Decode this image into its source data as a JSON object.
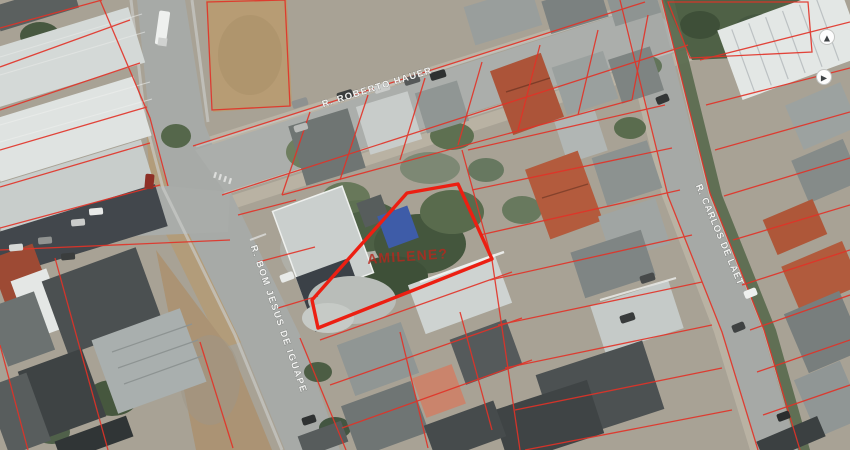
{
  "map": {
    "type": "aerial-cadastral-photo",
    "streets": {
      "roberto_hauer": "R. ROBERTO HAUER",
      "bom_jesus_de_iguape": "R. BOM JESUS DE IGUAPE",
      "carlos_de_laet": "R. CARLOS DE LAET"
    },
    "highlighted_parcel": {
      "annotation": "AMILENE?",
      "annotation_color": "#b5281e",
      "outline_color": "#ec1f12"
    },
    "overlay": {
      "cadastral_line_color": "#e23227"
    },
    "markers": [
      {
        "icon": "▲"
      },
      {
        "icon": "▶"
      }
    ],
    "colors": {
      "road": "#a7aaa7",
      "vegetation": "#4d6045",
      "dirt": "#b79c74"
    }
  }
}
